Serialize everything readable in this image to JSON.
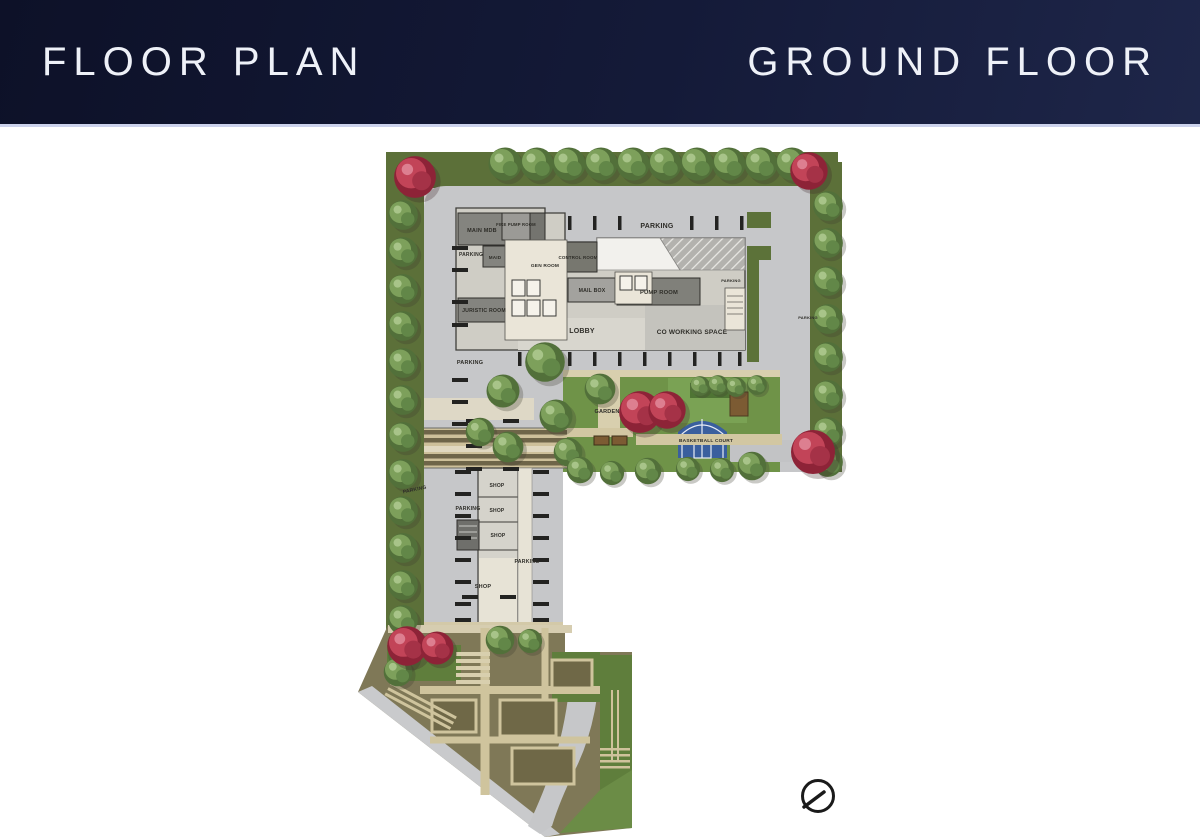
{
  "header": {
    "title": "FLOOR PLAN",
    "subtitle": "GROUND FLOOR"
  },
  "plan": {
    "labels": [
      {
        "text": "PARKING"
      },
      {
        "text": "MAIN MDB"
      },
      {
        "text": "FIRE PUMP ROOM"
      },
      {
        "text": "PARKING"
      },
      {
        "text": "MAID"
      },
      {
        "text": "GEN ROOM"
      },
      {
        "text": "CONTROL ROOM"
      },
      {
        "text": "MAIL BOX"
      },
      {
        "text": "PUMP ROOM"
      },
      {
        "text": "PARKING"
      },
      {
        "text": "JURISTIC ROOM"
      },
      {
        "text": "LOBBY"
      },
      {
        "text": "CO WORKING SPACE"
      },
      {
        "text": "PARKING"
      },
      {
        "text": "PARKING"
      },
      {
        "text": "GARDEN"
      },
      {
        "text": "BASKETBALL COURT"
      },
      {
        "text": "PARKING"
      },
      {
        "text": "SHOP"
      },
      {
        "text": "PARKING"
      },
      {
        "text": "SHOP"
      },
      {
        "text": "SHOP"
      },
      {
        "text": "PARKING"
      },
      {
        "text": "SHOP"
      }
    ]
  },
  "icons": {
    "compass": "compass-north-arrow"
  },
  "colors": {
    "header_bg": "#141a38",
    "header_text": "#eef1f8",
    "road_gray": "#c6c7c9",
    "border_green": "#5c7039",
    "garden_green": "#6f9348",
    "building_light": "#cfcdc5",
    "building_dark": "#84847f",
    "basketball_blue": "#3a5f9e",
    "red_tree": "#c24458",
    "path_tan": "#cfc29c",
    "plaza_brown": "#7f7857",
    "stall_mark": "#232321"
  }
}
